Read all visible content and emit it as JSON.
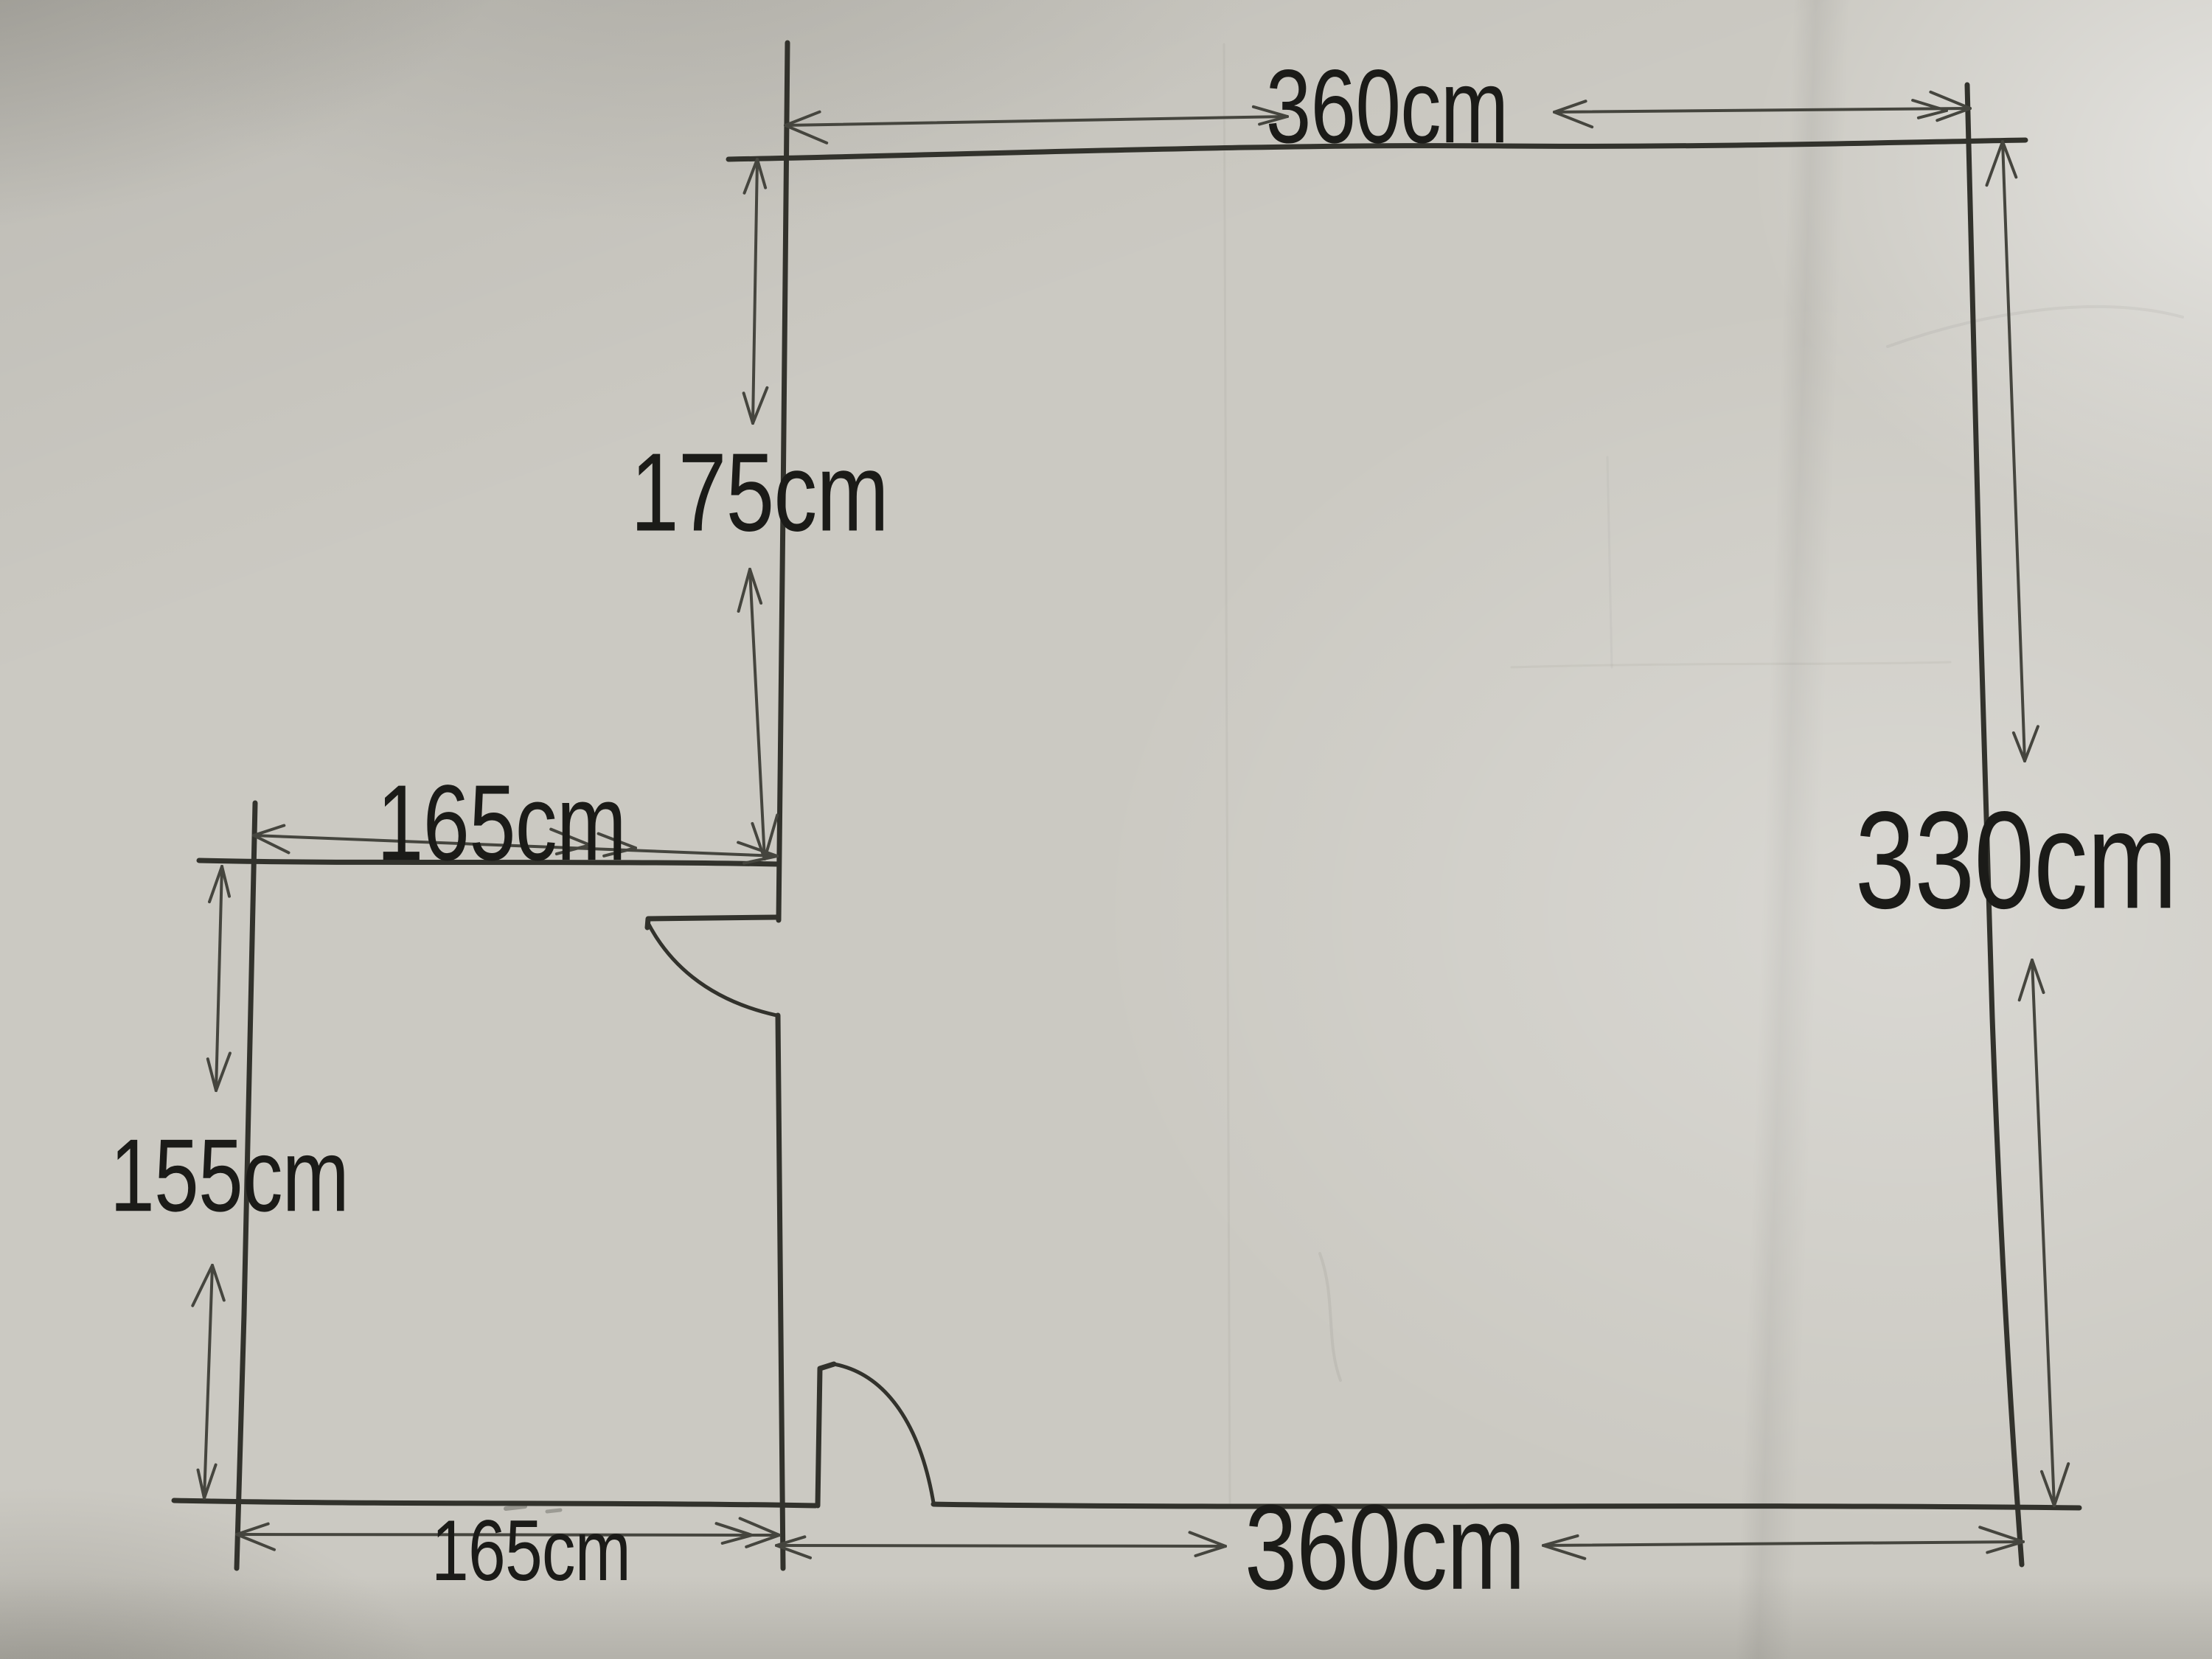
{
  "dimensions": {
    "top_width": "360cm",
    "upper_left_height": "175cm",
    "closet_width": "165cm",
    "right_height": "330cm",
    "closet_height": "155cm",
    "bottom_left_width": "165cm",
    "bottom_right_width": "360cm"
  },
  "colors": {
    "paper": "#cbc9c2",
    "wall_ink": "#32322c",
    "dimension_ink": "#45453e",
    "label_ink": "#1b1b18"
  }
}
